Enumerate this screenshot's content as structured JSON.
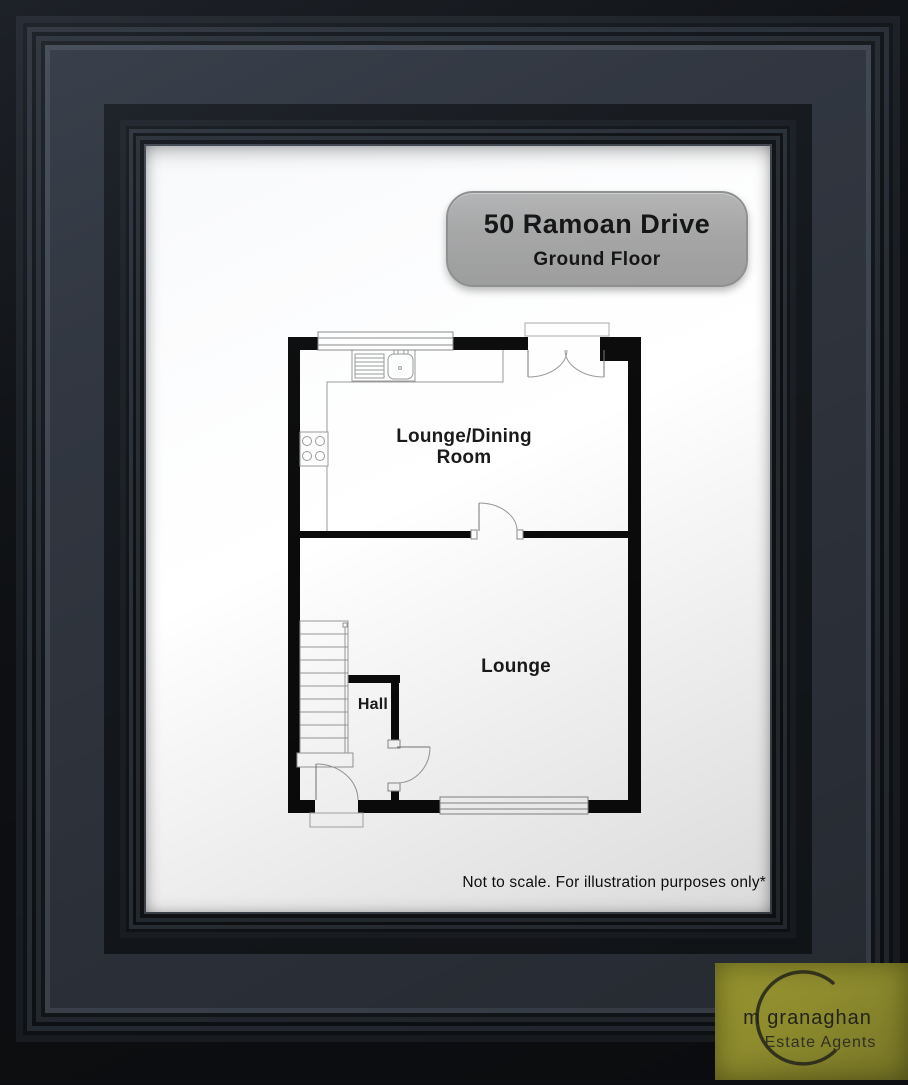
{
  "badge": {
    "title": "50 Ramoan Drive",
    "subtitle": "Ground Floor"
  },
  "plan": {
    "rooms": [
      {
        "id": "lounge-dining-room",
        "label_line1": "Lounge/Dining",
        "label_line2": "Room"
      },
      {
        "id": "lounge",
        "label": "Lounge"
      },
      {
        "id": "hall",
        "label": "Hall"
      }
    ],
    "features": [
      "top-window",
      "patio-double-doors",
      "kitchen-counter",
      "sink-drainer",
      "hob",
      "internal-door",
      "staircase",
      "hall-partition",
      "hall-door",
      "front-door",
      "bottom-window"
    ]
  },
  "disclaimer": {
    "text": "Not to scale. For illustration purposes only*"
  },
  "logo": {
    "name": "m granaghan",
    "tagline": "Estate Agents"
  },
  "colors": {
    "frame_band": "#2e333c",
    "mat": "#ffffff",
    "wall": "#0b0b0b",
    "badge_bg": "#a8a8a8",
    "logo_bg": "#8e8c2f",
    "label_text": "#1a1a1a"
  }
}
